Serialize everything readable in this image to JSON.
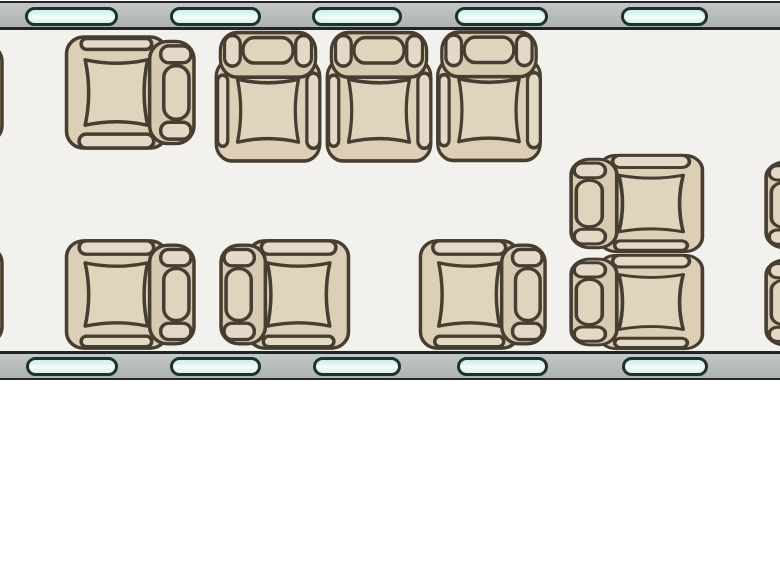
{
  "diagram": {
    "type": "aircraft-cabin-seating-plan",
    "view": "top-down-floorplan",
    "seat_count_full": 9,
    "seat_count_clipped": 4
  },
  "colors": {
    "page_bg": "#ffffff",
    "floor": "#f2f1ee",
    "wall": "#aeb2b1",
    "wall_light": "#c3c7c6",
    "wall_edge": "#202625",
    "outline": "#473e31",
    "seat_fill": "#dccfb6",
    "seat_fill_light": "#e3d9c6",
    "cushion_fill": "#e0d4bd",
    "backrest_fill": "#d7cab0",
    "window_fill": "#cdeeea",
    "window_bright": "#f2fbf9",
    "window_edge": "#1a3230"
  },
  "cabin": {
    "width": 780,
    "wall_top_y": 1,
    "wall_bottom_y": 351,
    "wall_thickness": 29,
    "window_top_y": 7,
    "window_bottom_y": 357,
    "windows_top": [
      {
        "x": 25,
        "w": 87
      },
      {
        "x": 170,
        "w": 85
      },
      {
        "x": 312,
        "w": 84
      },
      {
        "x": 455,
        "w": 87
      },
      {
        "x": 621,
        "w": 81
      }
    ],
    "windows_bottom": [
      {
        "x": 26,
        "w": 86
      },
      {
        "x": 170,
        "w": 85
      },
      {
        "x": 313,
        "w": 82
      },
      {
        "x": 457,
        "w": 85
      },
      {
        "x": 622,
        "w": 80
      }
    ],
    "seats": [
      {
        "id": "seat-clipped-left-upper",
        "x": -128,
        "y": 36,
        "w": 133,
        "h": 115,
        "facing": "left",
        "arm": "bottom",
        "clipped": true
      },
      {
        "id": "seat-single-forward",
        "x": 64,
        "y": 33,
        "w": 133,
        "h": 119,
        "facing": "left",
        "arm": "bottom",
        "clipped": false
      },
      {
        "id": "divan-seat-1",
        "x": 212,
        "y": 29,
        "w": 111,
        "h": 134,
        "facing": "down",
        "arm": "bottom",
        "clipped": false
      },
      {
        "id": "divan-seat-2",
        "x": 323,
        "y": 29,
        "w": 111,
        "h": 134,
        "facing": "down",
        "arm": "bottom",
        "clipped": false
      },
      {
        "id": "divan-seat-3",
        "x": 434,
        "y": 29,
        "w": 110,
        "h": 134,
        "facing": "down",
        "arm": "bottom",
        "clipped": false
      },
      {
        "id": "seat-pair-upper",
        "x": 568,
        "y": 152,
        "w": 137,
        "h": 103,
        "facing": "right",
        "arm": "top",
        "clipped": false
      },
      {
        "id": "seat-pair-lower",
        "x": 568,
        "y": 252,
        "w": 137,
        "h": 100,
        "facing": "right",
        "arm": "top",
        "clipped": false
      },
      {
        "id": "seat-clipped-left-lower",
        "x": -128,
        "y": 238,
        "w": 133,
        "h": 114,
        "facing": "left",
        "arm": "top",
        "clipped": true
      },
      {
        "id": "seat-lower-1",
        "x": 64,
        "y": 237,
        "w": 133,
        "h": 115,
        "facing": "left",
        "arm": "top",
        "clipped": false
      },
      {
        "id": "seat-lower-2",
        "x": 218,
        "y": 237,
        "w": 133,
        "h": 115,
        "facing": "right",
        "arm": "top",
        "clipped": false
      },
      {
        "id": "seat-lower-3",
        "x": 418,
        "y": 237,
        "w": 130,
        "h": 115,
        "facing": "left",
        "arm": "top",
        "clipped": false
      },
      {
        "id": "seat-clipped-right-upper",
        "x": 763,
        "y": 155,
        "w": 137,
        "h": 100,
        "facing": "right",
        "arm": "top",
        "clipped": true
      },
      {
        "id": "seat-clipped-right-lower",
        "x": 763,
        "y": 253,
        "w": 137,
        "h": 99,
        "facing": "right",
        "arm": "top",
        "clipped": true
      }
    ]
  }
}
